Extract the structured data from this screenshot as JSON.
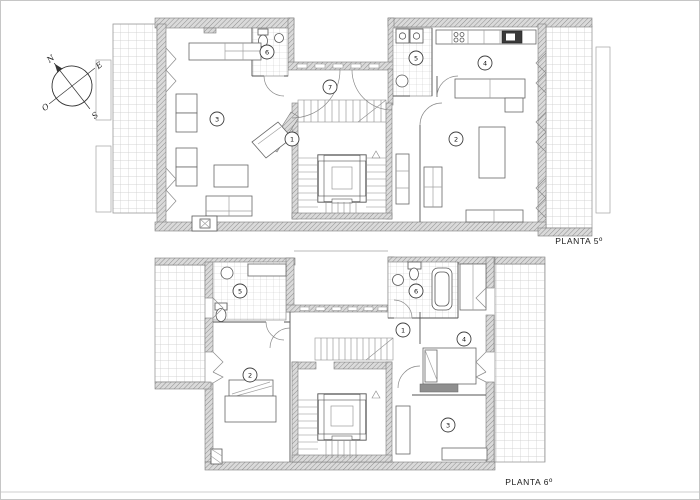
{
  "compass": {
    "north": "N",
    "east": "E",
    "south": "S",
    "west": "O"
  },
  "plans": [
    {
      "label": "PLANTA 5º",
      "rooms": [
        {
          "number": "1"
        },
        {
          "number": "2"
        },
        {
          "number": "3"
        },
        {
          "number": "4"
        },
        {
          "number": "5"
        },
        {
          "number": "6"
        },
        {
          "number": "7"
        }
      ]
    },
    {
      "label": "PLANTA 6º",
      "rooms": [
        {
          "number": "1"
        },
        {
          "number": "2"
        },
        {
          "number": "3"
        },
        {
          "number": "4"
        },
        {
          "number": "5"
        },
        {
          "number": "6"
        }
      ]
    }
  ],
  "colors": {
    "background": "#ffffff",
    "line": "#555555",
    "wall_fill": "#dadada",
    "wall_hatch": "#8f8f8f",
    "tile_grid": "#c9c9c9",
    "frame": "#c6c6c6"
  }
}
